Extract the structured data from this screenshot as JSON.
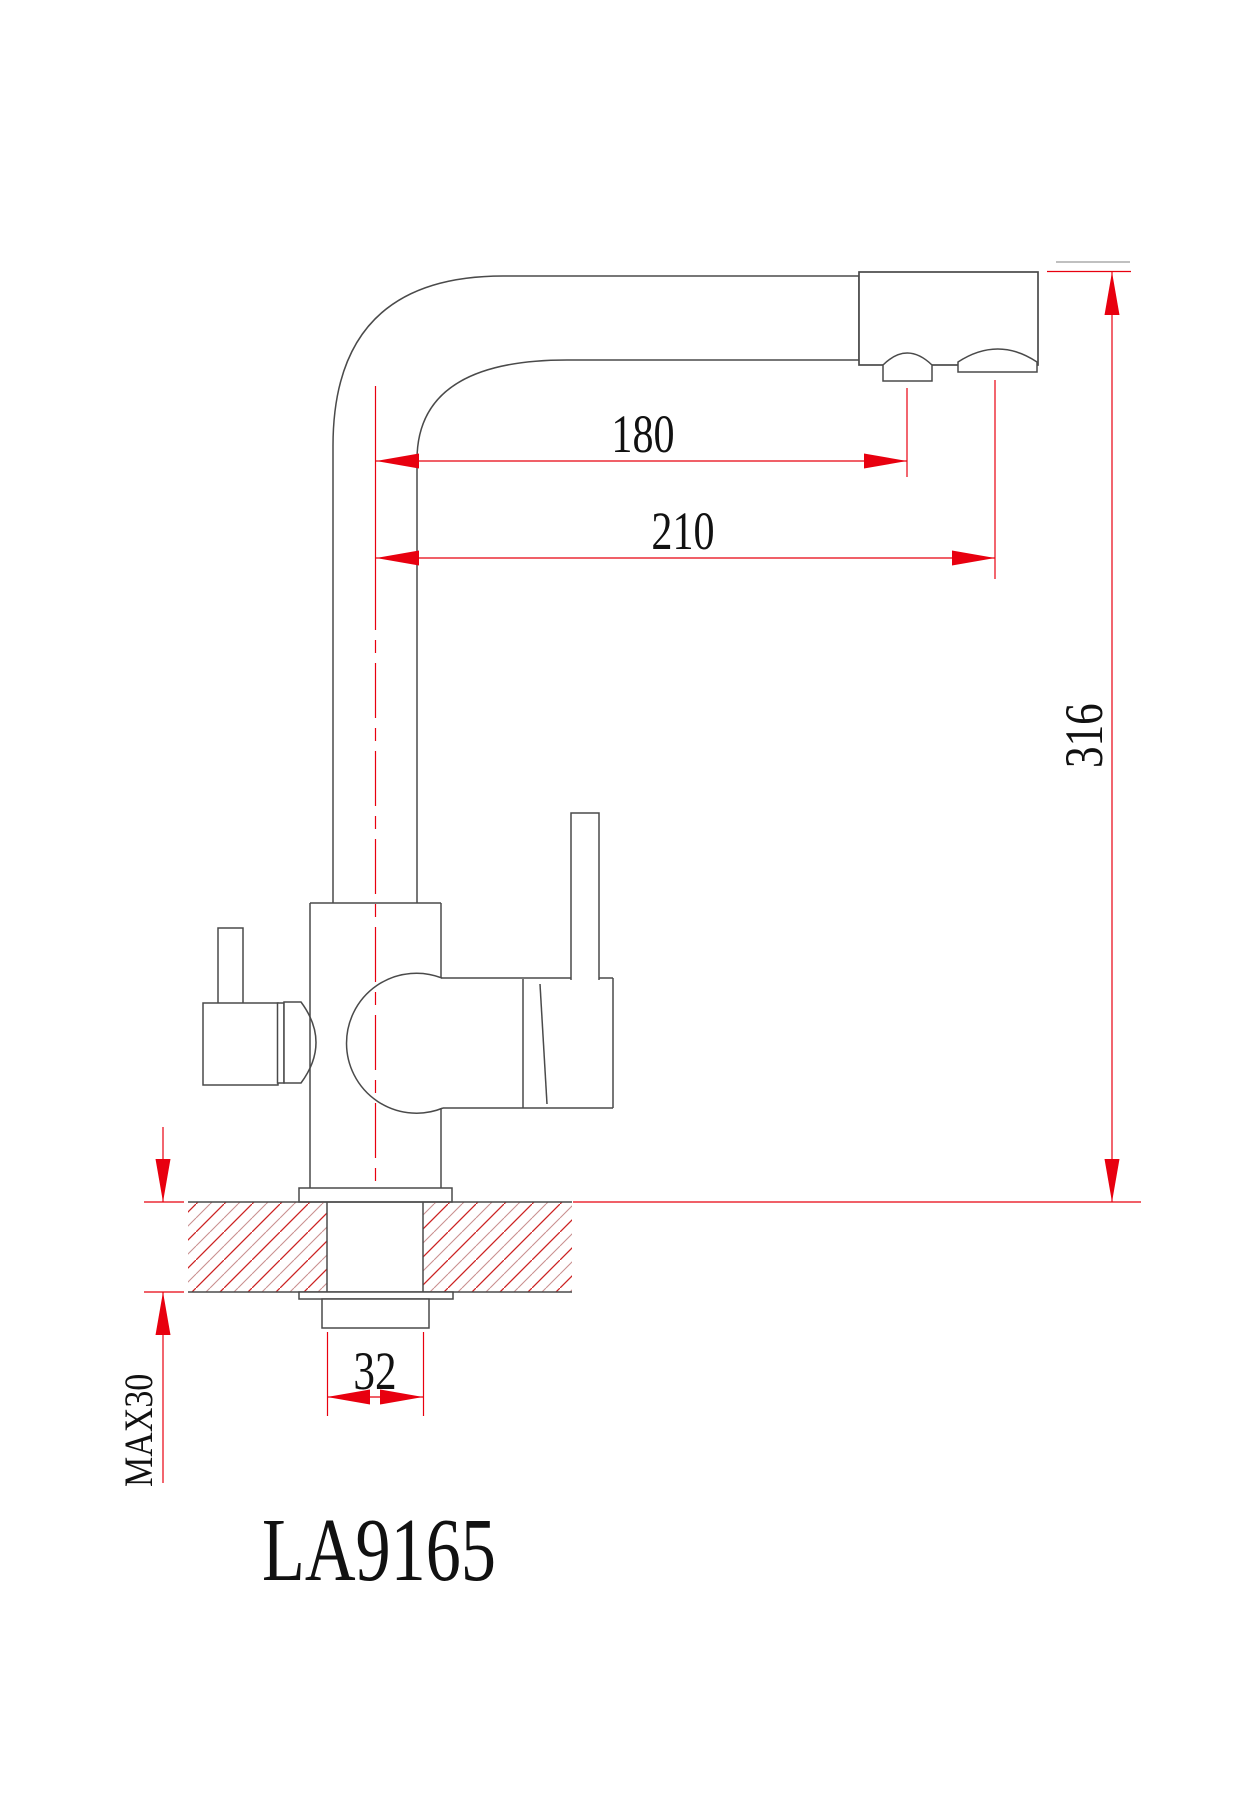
{
  "drawing": {
    "model_label": "LA9165",
    "dimension_labels": {
      "spout_reach": "180",
      "spout_reach_outer": "210",
      "spout_height": "316",
      "shank_width": "32",
      "max_counter_thickness": "MAX30"
    },
    "colors": {
      "dimension_red": "#e8000f",
      "outline_gray": "#4a4a4a",
      "hatch_red": "#cc2222",
      "hatch_light": "#c98f8f",
      "text_black": "#111111",
      "background": "#ffffff"
    }
  }
}
